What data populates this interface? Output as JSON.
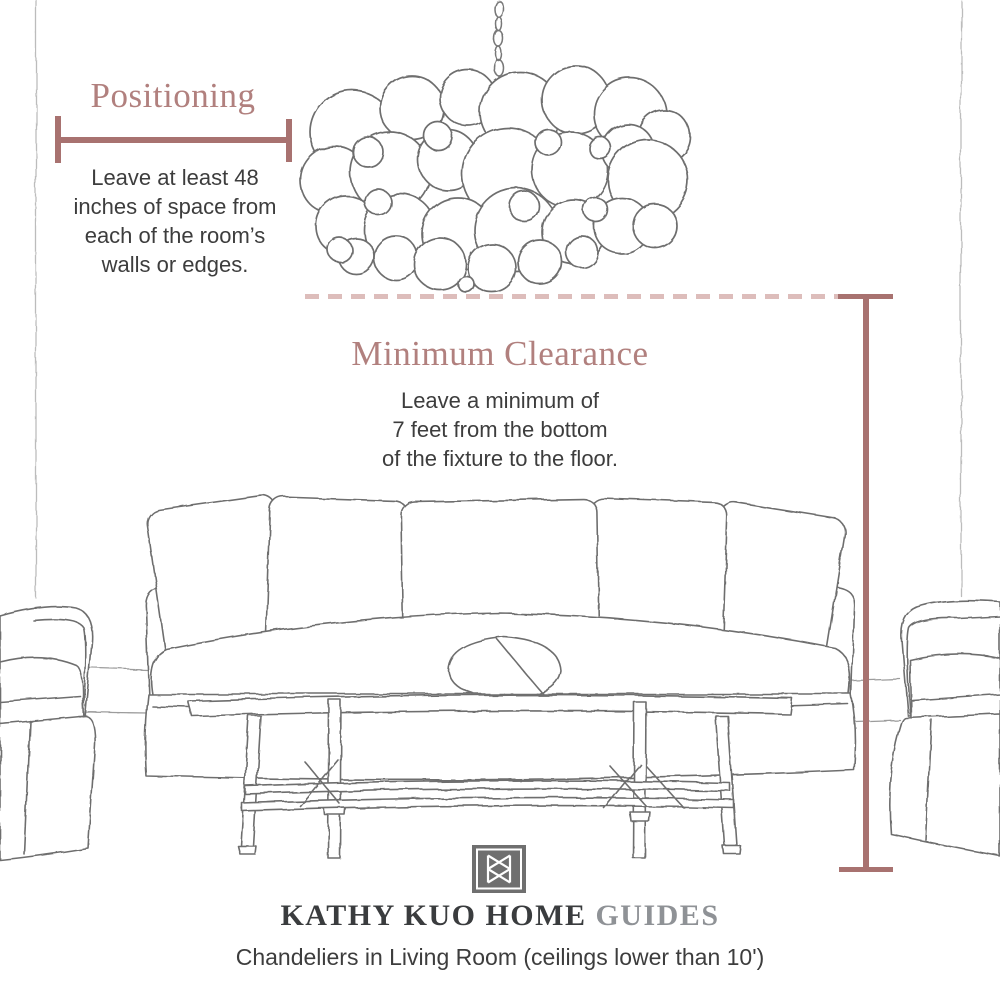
{
  "positioning": {
    "title": "Positioning",
    "lines": [
      "Leave at least 48",
      "inches of space from",
      "each of the room’s",
      "walls or edges."
    ]
  },
  "clearance": {
    "title": "Minimum Clearance",
    "lines": [
      "Leave a minimum of",
      "7 feet from the bottom",
      "of the fixture to the floor."
    ]
  },
  "footer": {
    "brand": "KATHY KUO HOME",
    "collection": "GUIDES",
    "subtitle": "Chandeliers in Living Room (ceilings lower than 10')"
  },
  "colors": {
    "rose_text": "#b1807e",
    "rose_line": "#a87270",
    "rose_dash": "#ddbdbb",
    "ink": "#3d3d3d",
    "brand_ink": "#3a3c3e",
    "guides_gray": "#8f9296",
    "sketch": "#6e6e6e",
    "wall_line": "#bcbcbc",
    "logo_bg": "#6f6f6f"
  },
  "icons": {
    "logo": "kathy-kuo-home-monogram",
    "chandelier": "bubble-chandelier-illustration",
    "sofa": "slipcover-sofa-illustration"
  }
}
